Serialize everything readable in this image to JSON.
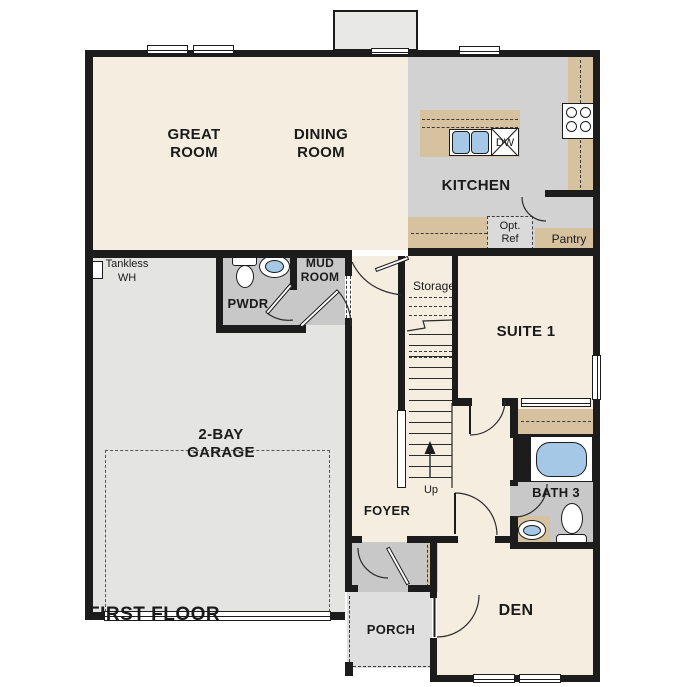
{
  "plan": {
    "title": "FIRST FLOOR",
    "rooms": {
      "great_room": "GREAT ROOM",
      "dining_room": "DINING ROOM",
      "kitchen": "KITCHEN",
      "suite1": "SUITE 1",
      "garage": "2-BAY GARAGE",
      "den": "DEN",
      "foyer": "FOYER",
      "porch": "PORCH",
      "bath3": "BATH 3",
      "mud_room": "MUD ROOM",
      "pwdr": "PWDR",
      "pantry": "Pantry",
      "storage": "Storage",
      "opt_ref": "Opt. Ref",
      "dw": "DW",
      "tankless_wh": "Tankless WH",
      "up": "Up"
    },
    "colors": {
      "wall": "#1c1c1c",
      "floor_cream": "#f6ede1",
      "kitchen_gray": "#d2d2d2",
      "counter_tan": "#d7c2a0",
      "water_blue": "#a5c8e6",
      "garage_gray": "#e4e4e2",
      "room_gray": "#c8c8c8",
      "porch_gray": "#dfdfdf",
      "bumpout_gray": "#e8e8e6",
      "optref_gray": "#dadada"
    }
  }
}
